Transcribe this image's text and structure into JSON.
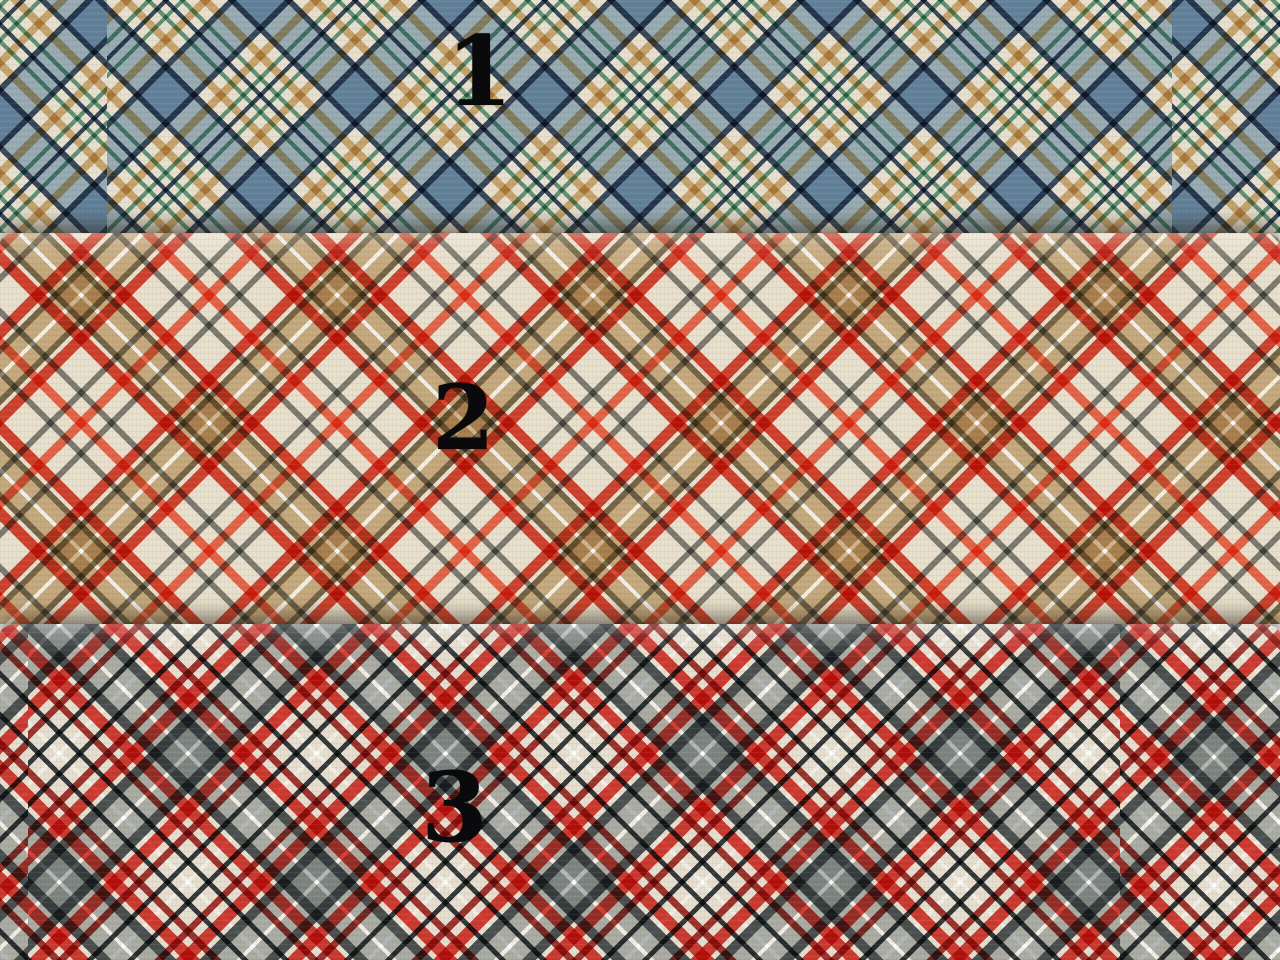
{
  "photo": {
    "description": "Three overlapping plaid cotton fabric swatches photographed flat, numbered 1, 2 and 3",
    "swatches": [
      {
        "label": "1",
        "name": "blue diagonal tartan on cream",
        "colors": {
          "base": "#ece7db",
          "band_blue": "#8ba6ba",
          "edge_navy": "#2d3e52",
          "stripe_tan": "#c7a670",
          "stripe_teal": "#5b917c"
        }
      },
      {
        "label": "2",
        "name": "red and khaki diagonal tartan on cream",
        "colors": {
          "base": "#ece8df",
          "band_khaki": "#c5a87e",
          "stripe_red": "#cd3a2b",
          "stripe_red_light": "#e95f47",
          "stripe_olive": "#6e5e42",
          "stripe_gray": "#76766d",
          "stripe_white": "#f4efe2"
        }
      },
      {
        "label": "3",
        "name": "grey and red diagonal tartan on cream",
        "colors": {
          "base": "#e8e4da",
          "band_gray": "#a7acaa",
          "edge_charcoal": "#464d4f",
          "stripe_red": "#cb3530",
          "stripe_dark_red": "#9a2c26",
          "stripe_black": "#2d3133",
          "stripe_white": "#f2efe7"
        }
      }
    ]
  },
  "css_vars": {
    "f1-base": "#f3efe5",
    "f1-blue": "#9fb6c6",
    "f1-navy": "#3a4c62",
    "f1-tan": "#cfae79",
    "f1-teal": "#659a81",
    "f2-base": "#f3efe4",
    "f2-khaki": "#cfb48c",
    "f2-red": "#d84531",
    "f2-redlight": "#ee6a4e",
    "f2-olive": "#7b6b4d",
    "f2-gray": "#82827a",
    "f2-white": "#ffffff",
    "f3-base": "#f2eee5",
    "f3-gray": "#b3b8b5",
    "f3-charcoal": "#4e5557",
    "f3-red": "#d63e35",
    "f3-darkred": "#a33630",
    "f3-black": "#363b3d",
    "f3-white": "#ffffff"
  }
}
